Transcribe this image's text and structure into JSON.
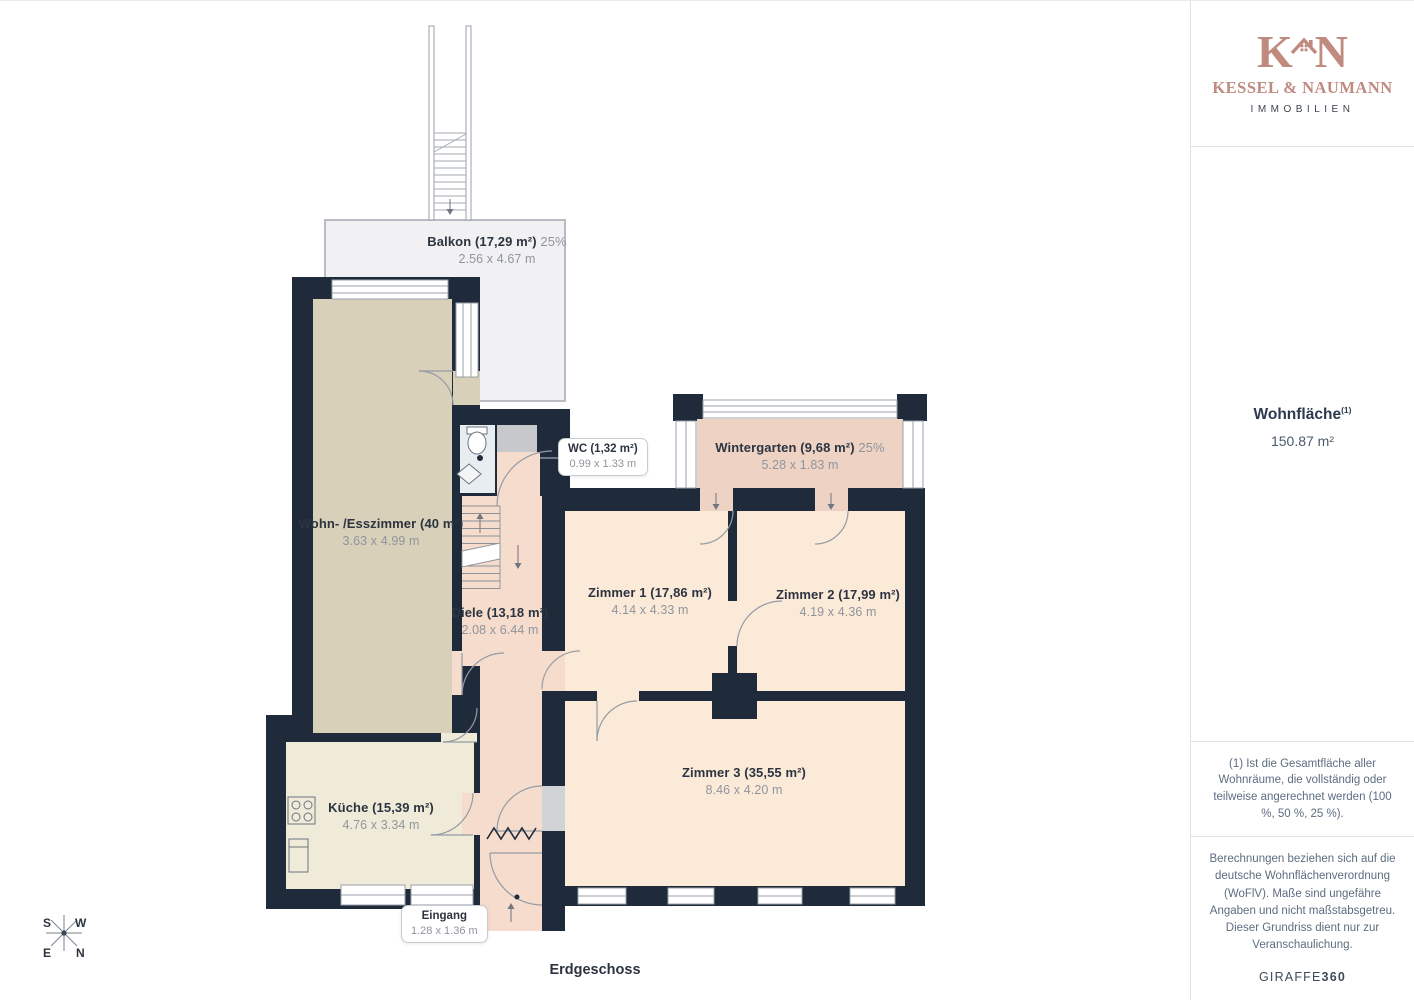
{
  "page": {
    "floor_label": "Erdgeschoss"
  },
  "branding": {
    "monogram_left": "K",
    "monogram_right": "N",
    "company": "KESSEL & NAUMANN",
    "tagline": "IMMOBILIEN"
  },
  "summary": {
    "title": "Wohnfläche",
    "title_sup": "(1)",
    "value": "150.87 m²"
  },
  "notes": {
    "footnote": "(1) Ist die Gesamtfläche aller Wohnräume, die vollständig oder teilweise angerechnet werden (100 %, 50 %, 25 %).",
    "disclaimer": "Berechnungen beziehen sich auf die deutsche Wohnflächenverordnung (WoFlV). Maße sind ungefähre Angaben und nicht maßstabsgetreu. Dieser Grundriss dient nur zur Veranschaulichung.",
    "brand_name": "GIRAFFE",
    "brand_suffix": "360"
  },
  "compass": {
    "top_left": "S",
    "top_right": "W",
    "bottom_left": "E",
    "bottom_right": "N"
  },
  "rooms": {
    "balkon": {
      "name": "Balkon (17,29 m²)",
      "share": "25%",
      "dims": "2.56 x 4.67 m"
    },
    "wc": {
      "name": "WC (1,32 m²)",
      "dims": "0.99 x 1.33 m"
    },
    "wintergarten": {
      "name": "Wintergarten (9,68 m²)",
      "share": "25%",
      "dims": "5.28 x 1.83 m"
    },
    "wohn_esszimmer": {
      "name": "Wohn- /Esszimmer (40 m²)",
      "dims": "3.63 x 4.99 m"
    },
    "zimmer1": {
      "name": "Zimmer 1 (17,86 m²)",
      "dims": "4.14 x 4.33 m"
    },
    "zimmer2": {
      "name": "Zimmer 2 (17,99 m²)",
      "dims": "4.19 x 4.36 m"
    },
    "diele": {
      "name": "Diele (13,18 m²)",
      "dims": "2.08 x 6.44 m"
    },
    "zimmer3": {
      "name": "Zimmer 3 (35,55 m²)",
      "dims": "8.46 x 4.20 m"
    },
    "kueche": {
      "name": "Küche (15,39 m²)",
      "dims": "4.76 x 3.34 m"
    },
    "eingang": {
      "name": "Eingang",
      "dims": "1.28 x 1.36 m"
    }
  },
  "colors": {
    "wall": "#1f2b3a",
    "accent_rose": "#c08a7f",
    "floor_living": "#d8d0b8",
    "floor_kitchen": "#f0ebd9",
    "floor_hall": "#f6dccd",
    "floor_room": "#fcead9",
    "floor_wintergarten": "#eed3c4",
    "floor_wc": "#e8edf2",
    "floor_balcony": "#f1f1f3",
    "label_dark": "#2b3440",
    "label_gray": "#90959d"
  }
}
